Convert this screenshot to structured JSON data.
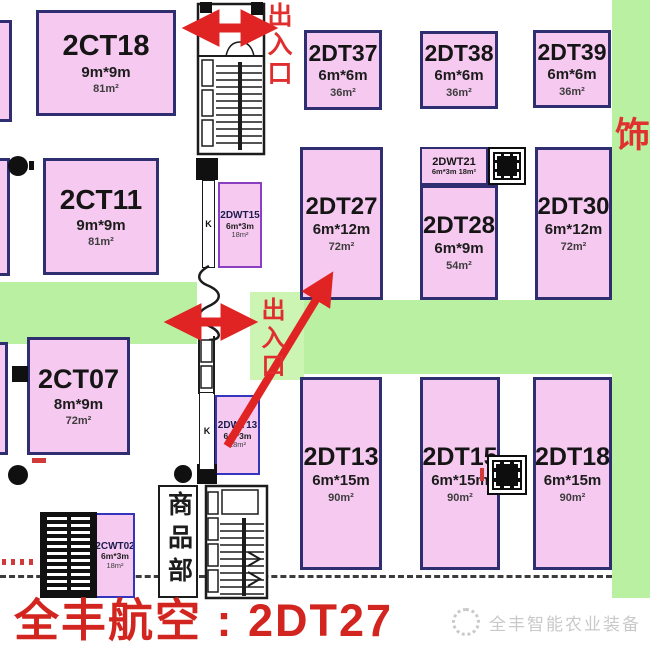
{
  "colors": {
    "booth_fill": "#f6c9f0",
    "booth_border_navy": "#2e2e70",
    "booth_border_purple": "#8a3fc0",
    "booth_border_blue": "#3434bd",
    "aisle_green": "#b9f0a2",
    "accent_red": "#e02424",
    "legend_red": "#d3251f",
    "watermark_gray": "#c9c9c9"
  },
  "entrances": {
    "top": "出入口",
    "middle": "出入口"
  },
  "banner": {
    "text": "品牌特装饰"
  },
  "shop": {
    "label": "商品部"
  },
  "k_labels": [
    "K",
    "K"
  ],
  "legend": {
    "text": "全丰航空 : 2DT27"
  },
  "watermark": {
    "logo": "circle-logo-icon",
    "text": "全丰智能农业装备"
  },
  "highlight_booth": "2DT27",
  "booths": [
    {
      "id": "2CT18",
      "name": "2CT18",
      "size": "9m*9m",
      "area": "81m²",
      "x": 36,
      "y": 10,
      "w": 140,
      "h": 106,
      "cls": "big",
      "border": "navy",
      "nfs": 29
    },
    {
      "id": "2CT11",
      "name": "2CT11",
      "size": "9m*9m",
      "area": "81m²",
      "x": 43,
      "y": 158,
      "w": 116,
      "h": 117,
      "cls": "big",
      "border": "navy",
      "nfs": 28
    },
    {
      "id": "2CT07",
      "name": "2CT07",
      "size": "8m*9m",
      "area": "72m²",
      "x": 27,
      "y": 337,
      "w": 103,
      "h": 118,
      "cls": "big",
      "border": "navy",
      "nfs": 27
    },
    {
      "id": "2DT37",
      "name": "2DT37",
      "size": "6m*6m",
      "area": "36m²",
      "x": 304,
      "y": 30,
      "w": 78,
      "h": 80,
      "cls": "big",
      "border": "navy",
      "nfs": 23
    },
    {
      "id": "2DT38",
      "name": "2DT38",
      "size": "6m*6m",
      "area": "36m²",
      "x": 420,
      "y": 31,
      "w": 78,
      "h": 78,
      "cls": "big",
      "border": "navy",
      "nfs": 23
    },
    {
      "id": "2DT39",
      "name": "2DT39",
      "size": "6m*6m",
      "area": "36m²",
      "x": 533,
      "y": 30,
      "w": 78,
      "h": 78,
      "cls": "big",
      "border": "navy",
      "nfs": 23
    },
    {
      "id": "2DT27",
      "name": "2DT27",
      "size": "6m*12m",
      "area": "72m²",
      "x": 300,
      "y": 147,
      "w": 83,
      "h": 153,
      "cls": "big",
      "border": "navy",
      "nfs": 24
    },
    {
      "id": "2DWT21",
      "name": "2DWT21",
      "size": "6m*3m",
      "area": "18m²",
      "x": 420,
      "y": 147,
      "w": 68,
      "h": 38,
      "cls": "tiny-h",
      "border": "navy"
    },
    {
      "id": "2DT28",
      "name": "2DT28",
      "size": "6m*9m",
      "area": "54m²",
      "x": 420,
      "y": 185,
      "w": 78,
      "h": 115,
      "cls": "big",
      "border": "navy",
      "nfs": 24
    },
    {
      "id": "2DT30",
      "name": "2DT30",
      "size": "6m*12m",
      "area": "72m²",
      "x": 535,
      "y": 147,
      "w": 77,
      "h": 153,
      "cls": "big",
      "border": "navy",
      "nfs": 24
    },
    {
      "id": "2DWT15",
      "name": "2DWT15",
      "size": "6m*3m",
      "area": "18m²",
      "x": 218,
      "y": 182,
      "w": 44,
      "h": 86,
      "cls": "tiny",
      "border": "purple"
    },
    {
      "id": "2DWT13",
      "name": "2DWT13",
      "size": "6m*3m",
      "area": "18m²",
      "x": 215,
      "y": 395,
      "w": 45,
      "h": 80,
      "cls": "tiny",
      "border": "blue"
    },
    {
      "id": "2DT13",
      "name": "2DT13",
      "size": "6m*15m",
      "area": "90m²",
      "x": 300,
      "y": 377,
      "w": 82,
      "h": 193,
      "cls": "big",
      "border": "navy",
      "nfs": 25
    },
    {
      "id": "2DT15",
      "name": "2DT15",
      "size": "6m*15m",
      "area": "90m²",
      "x": 420,
      "y": 377,
      "w": 80,
      "h": 193,
      "cls": "big",
      "border": "navy",
      "nfs": 25
    },
    {
      "id": "2DT18",
      "name": "2DT18",
      "size": "6m*15m",
      "area": "90m²",
      "x": 533,
      "y": 377,
      "w": 79,
      "h": 193,
      "cls": "big",
      "border": "navy",
      "nfs": 25
    },
    {
      "id": "2CWT02",
      "name": "2CWT02",
      "size": "6m*3m",
      "area": "18m²",
      "x": 95,
      "y": 513,
      "w": 40,
      "h": 85,
      "cls": "tiny",
      "border": "blue"
    },
    {
      "id": "frag-a",
      "name": "",
      "size": "",
      "area": "",
      "x": -8,
      "y": 20,
      "w": 20,
      "h": 102,
      "cls": "frag",
      "border": "navy"
    },
    {
      "id": "frag-b",
      "name": "",
      "size": "",
      "area": "",
      "x": -8,
      "y": 158,
      "w": 18,
      "h": 118,
      "cls": "frag",
      "border": "navy"
    },
    {
      "id": "frag-c",
      "name": "",
      "size": "",
      "area": "",
      "x": -8,
      "y": 342,
      "w": 16,
      "h": 113,
      "cls": "frag",
      "border": "navy"
    }
  ]
}
